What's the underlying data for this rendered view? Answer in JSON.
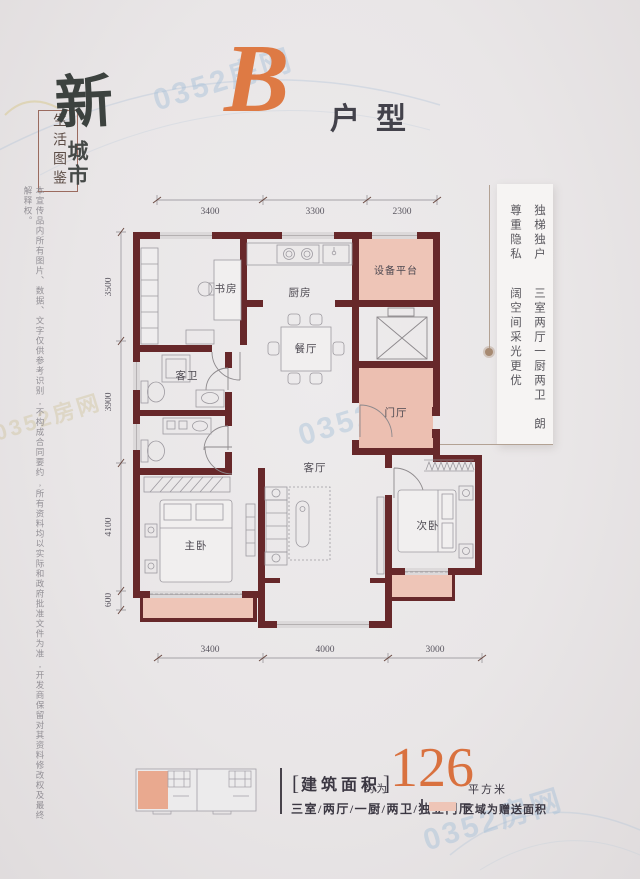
{
  "watermark": {
    "text": "0352房网"
  },
  "brand": {
    "calligraphy": "新",
    "city": "城市",
    "box_label": "生活图鉴"
  },
  "header": {
    "unit_letter": "B",
    "unit_type": "户型"
  },
  "side_note": {
    "disclaimer": "本宣传品内所有图片、数据、文字仅供参考识别,不构成合同要约,所有资料均以实际和政府批准文件为准,开发商保留对其资料修改权及最终解释权。"
  },
  "features": {
    "line1": "独梯独户　尊重隐私",
    "line2": "三室两厅一厨两卫　朗阔空间采光更优"
  },
  "floorplan": {
    "rooms": {
      "study": "书房",
      "kitchen": "厨房",
      "equipment": "设备平台",
      "dining": "餐厅",
      "guest_bath": "客卫",
      "foyer": "门厅",
      "living": "客厅",
      "master": "主卧",
      "second": "次卧"
    },
    "dims_top": [
      "3400",
      "3300",
      "2300"
    ],
    "dims_left": [
      "3500",
      "3900",
      "4100",
      "600"
    ],
    "dims_bottom": [
      "3400",
      "4000",
      "3000"
    ]
  },
  "footer": {
    "bracket_left": "[",
    "area_label": "建筑面积",
    "bracket_right": "]",
    "approx": "约为",
    "area_value": "126",
    "area_unit": "平方米",
    "layout_desc": "三室/两厅/一厨/两卫/独立门厅",
    "legend_note": "区域为赠送面积"
  },
  "colors": {
    "accent": "#de7a44",
    "wall": "#67282a",
    "bonus_pink": "#eec5b7",
    "keyplan_pink": "#e9a98f"
  }
}
